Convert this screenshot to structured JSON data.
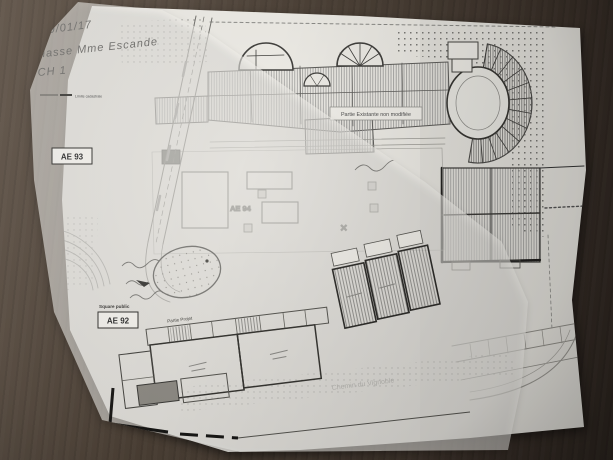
{
  "photo": {
    "description": "Photograph of architectural site plans (base plan with tracing-paper overlay) on a dark wooden desk",
    "table_color": "#463b31",
    "paper_color": "#f1efe9"
  },
  "handwriting": {
    "date": "19/01/17",
    "class_note": "Classe Mme Escande",
    "room_note": "CH 1"
  },
  "plan": {
    "parcel_ae93": "AE 93",
    "parcel_ae94": "AE 94",
    "parcel_ae92": "AE 92",
    "existing_note": "Partie Existante non modifiée",
    "project_note": "Partie Projet",
    "square_note": "Square public",
    "street_name": "Chemin du Vignoble",
    "legend_item": "Limite cadastrale",
    "x_mark": "✕"
  }
}
